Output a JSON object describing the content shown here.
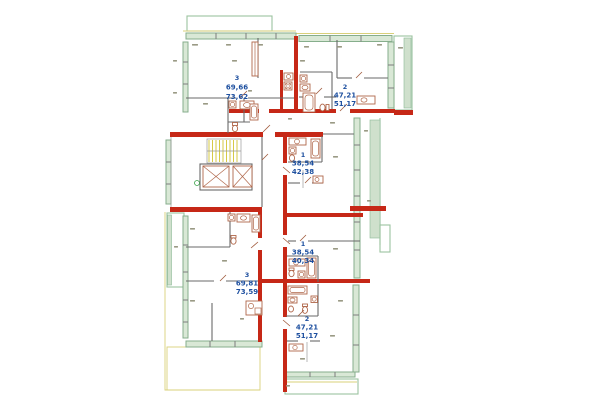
{
  "plan": {
    "type": "residential-floor-plan",
    "apartments": [
      {
        "id": "apartment-top-left",
        "rooms": "3",
        "area_living": "69,66",
        "area_total": "73,62"
      },
      {
        "id": "apartment-top-right",
        "rooms": "2",
        "area_living": "47,21",
        "area_total": "51,17"
      },
      {
        "id": "apartment-mid-upper",
        "rooms": "1",
        "area_living": "38,54",
        "area_total": "42,38"
      },
      {
        "id": "apartment-mid-lower",
        "rooms": "1",
        "area_living": "38,54",
        "area_total": "40,34"
      },
      {
        "id": "apartment-bottom-left",
        "rooms": "3",
        "area_living": "69,81",
        "area_total": "73,59"
      },
      {
        "id": "apartment-bottom",
        "rooms": "2",
        "area_living": "47,21",
        "area_total": "51,17"
      }
    ],
    "colors": {
      "load_bearing_wall": "#c62817",
      "partition_wall": "#6a6a6a",
      "window_glass": "#d9e8d6",
      "window_frame": "#86ae8c",
      "balcony_outline": "#9cc3a0",
      "stair_accent": "#d6ca45",
      "sill_line": "#d9d07a",
      "fixture_outline": "#b0674a",
      "label_text": "#1d4f9f",
      "background": "#ffffff"
    }
  }
}
